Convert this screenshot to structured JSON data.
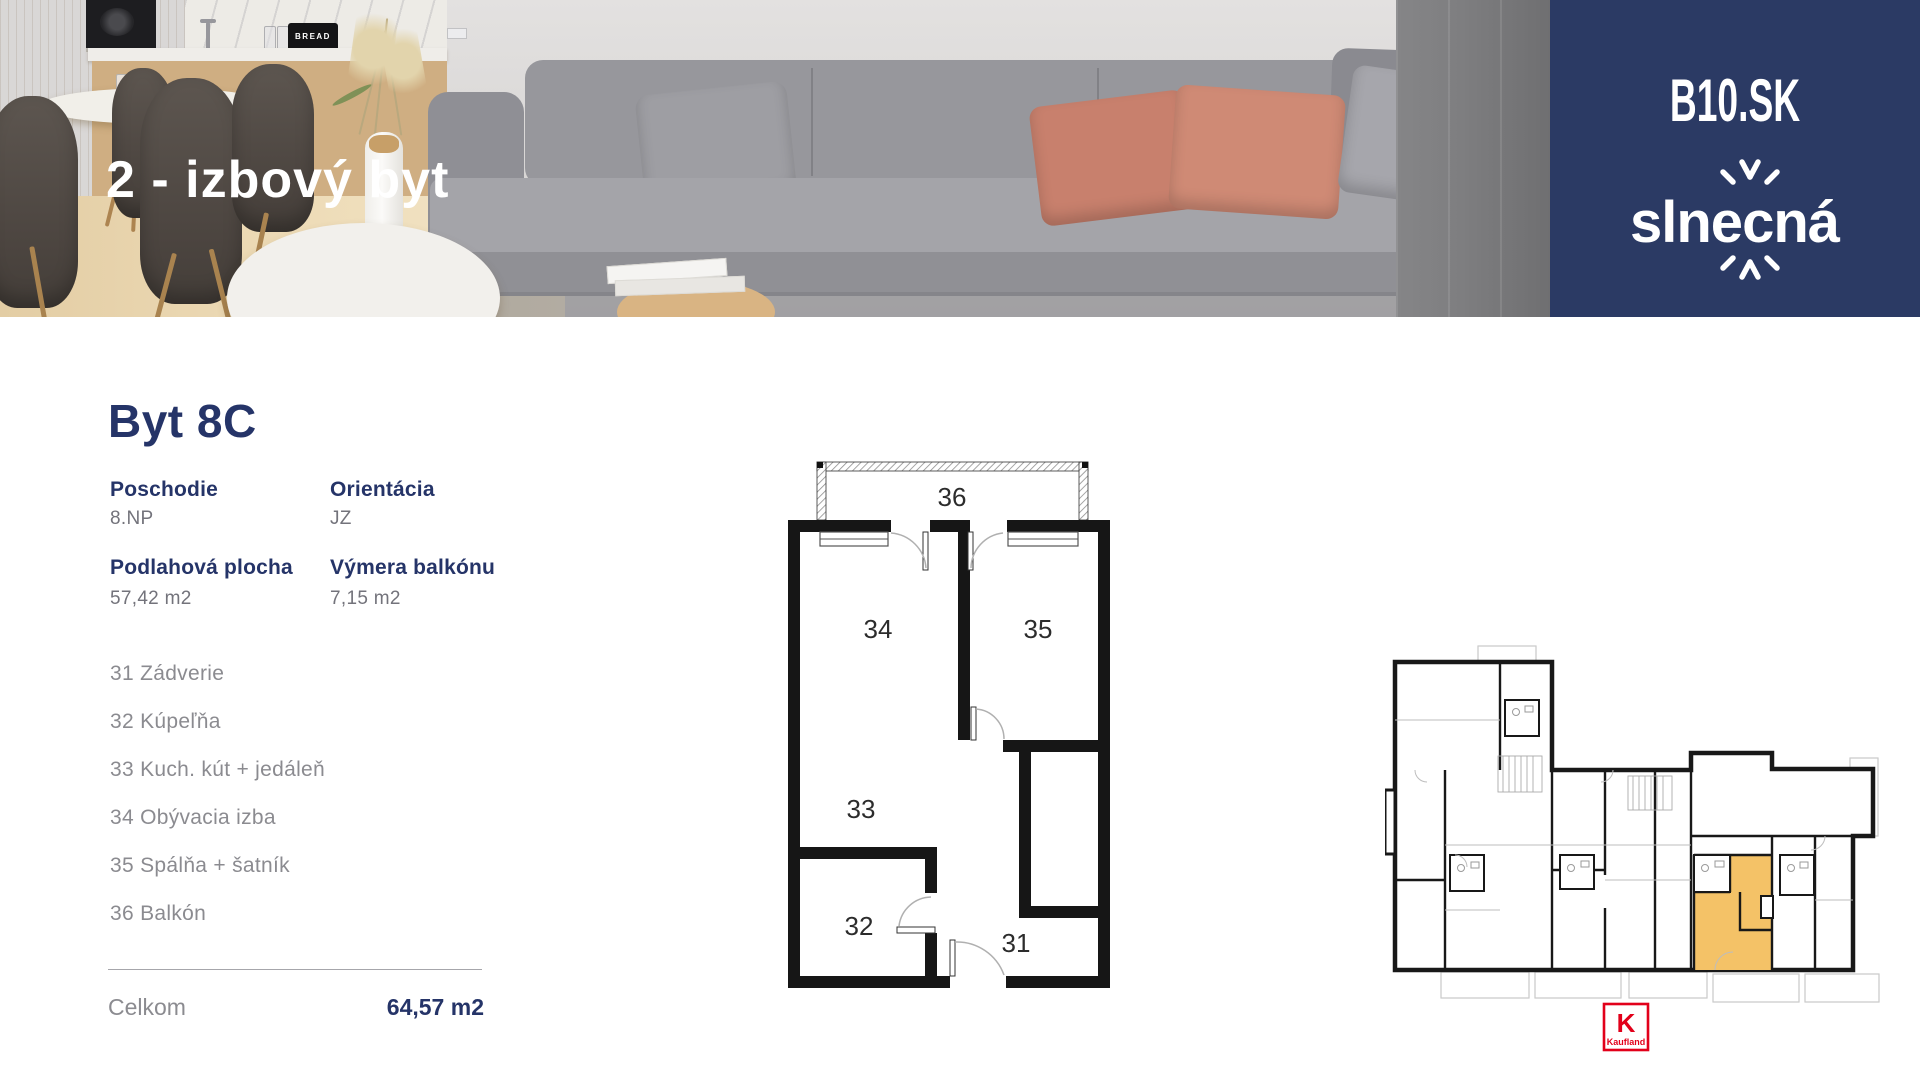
{
  "hero": {
    "title": "2 - izbový byt",
    "bread_label": "BREAD"
  },
  "brand": {
    "site": "B10.SK",
    "logo_pre": "slne",
    "logo_c": "c",
    "logo_post": "ná"
  },
  "apartment": {
    "name": "Byt 8C",
    "details": [
      {
        "label": "Poschodie",
        "value": "8.NP"
      },
      {
        "label": "Orientácia",
        "value": "JZ"
      },
      {
        "label": "Podlahová plocha",
        "value": "57,42 m2"
      },
      {
        "label": "Výmera balkónu",
        "value": "7,15 m2"
      }
    ],
    "rooms": [
      "31 Zádverie",
      "32 Kúpeľňa",
      "33 Kuch. kút + jedáleň",
      "34 Obývacia izba",
      "35 Spálňa + šatník",
      "36 Balkón"
    ],
    "total_label": "Celkom",
    "total_value": "64,57 m2"
  },
  "floorplan": {
    "labels": [
      "36",
      "34",
      "35",
      "33",
      "32",
      "31"
    ]
  },
  "site_plan": {
    "highlight_color": "#f4c267"
  },
  "kaufland": {
    "k_letter": "K",
    "name": "Kaufland"
  },
  "colors": {
    "navy": "#2b3a64",
    "heading": "#253468",
    "muted": "#8b8b90",
    "highlight": "#f4c267",
    "kaufland_red": "#e2001a"
  }
}
